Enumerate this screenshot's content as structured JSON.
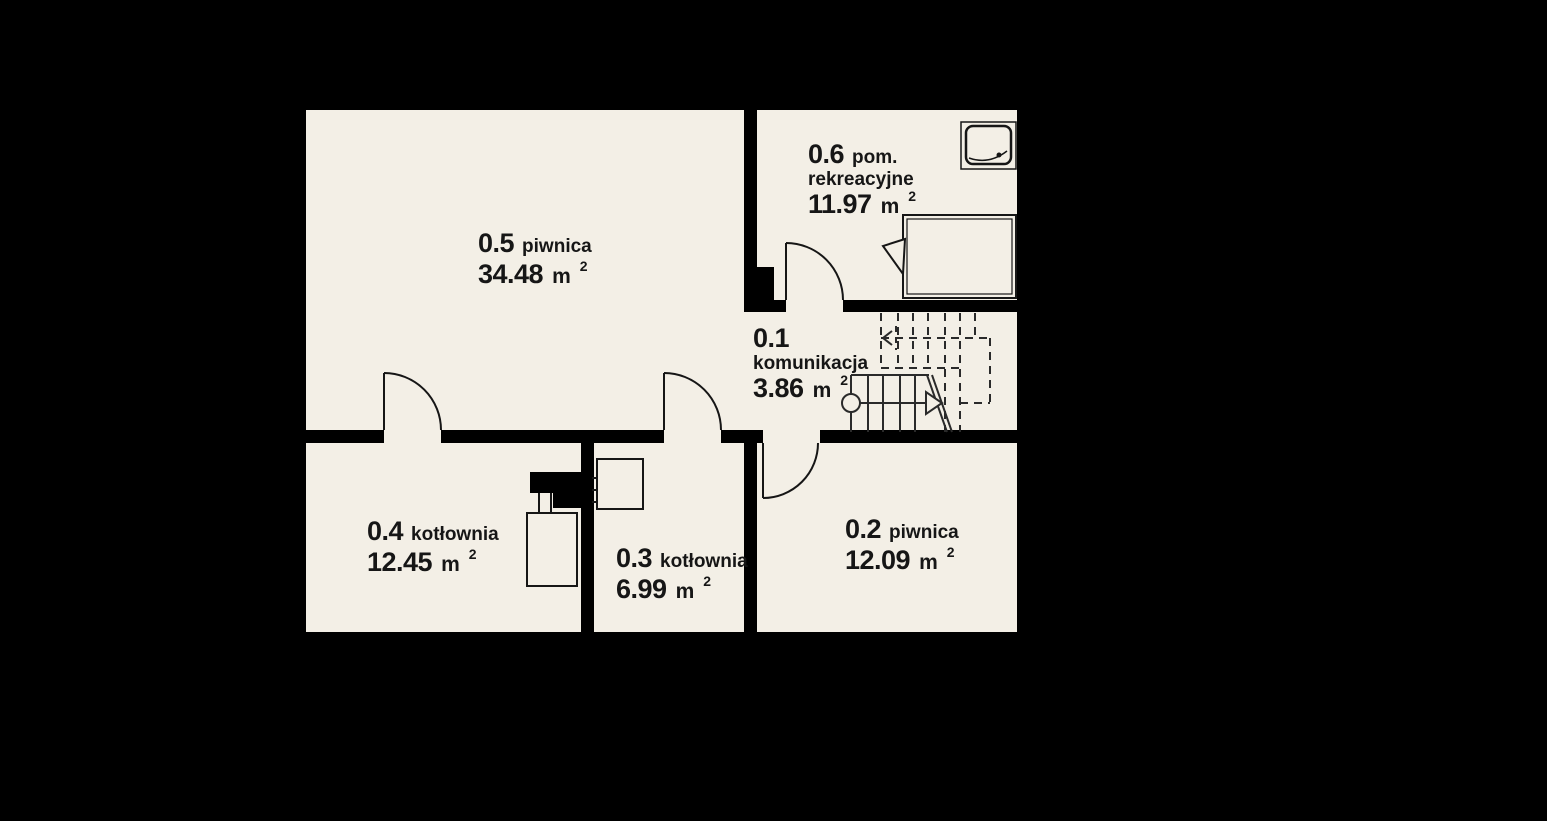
{
  "colors": {
    "background": "#000000",
    "floor_fill": "#f3efe6",
    "wall_fill": "#000000",
    "line_color": "#161616"
  },
  "area_unit": "m",
  "area_exponent": "2",
  "rooms": [
    {
      "number": "0.5",
      "name": "piwnica",
      "area": "34.48"
    },
    {
      "number": "0.6",
      "name": "pom.",
      "name2": "rekreacyjne",
      "area": "11.97"
    },
    {
      "number": "0.1",
      "name": "komunikacja",
      "area": "3.86"
    },
    {
      "number": "0.4",
      "name": "kotłownia",
      "area": "12.45"
    },
    {
      "number": "0.3",
      "name": "kotłownia",
      "area": "6.99"
    },
    {
      "number": "0.2",
      "name": "piwnica",
      "area": "12.09"
    }
  ],
  "fixtures": {
    "shower": "shower-tray-icon",
    "bed": "bed-icon",
    "boiler": "boiler-icon",
    "chimney": "chimney-icon",
    "water_heater": "water-heater-icon",
    "stairs_down": "stairs-lower-flight",
    "stairs_up_dashed": "stairs-upper-flight"
  }
}
